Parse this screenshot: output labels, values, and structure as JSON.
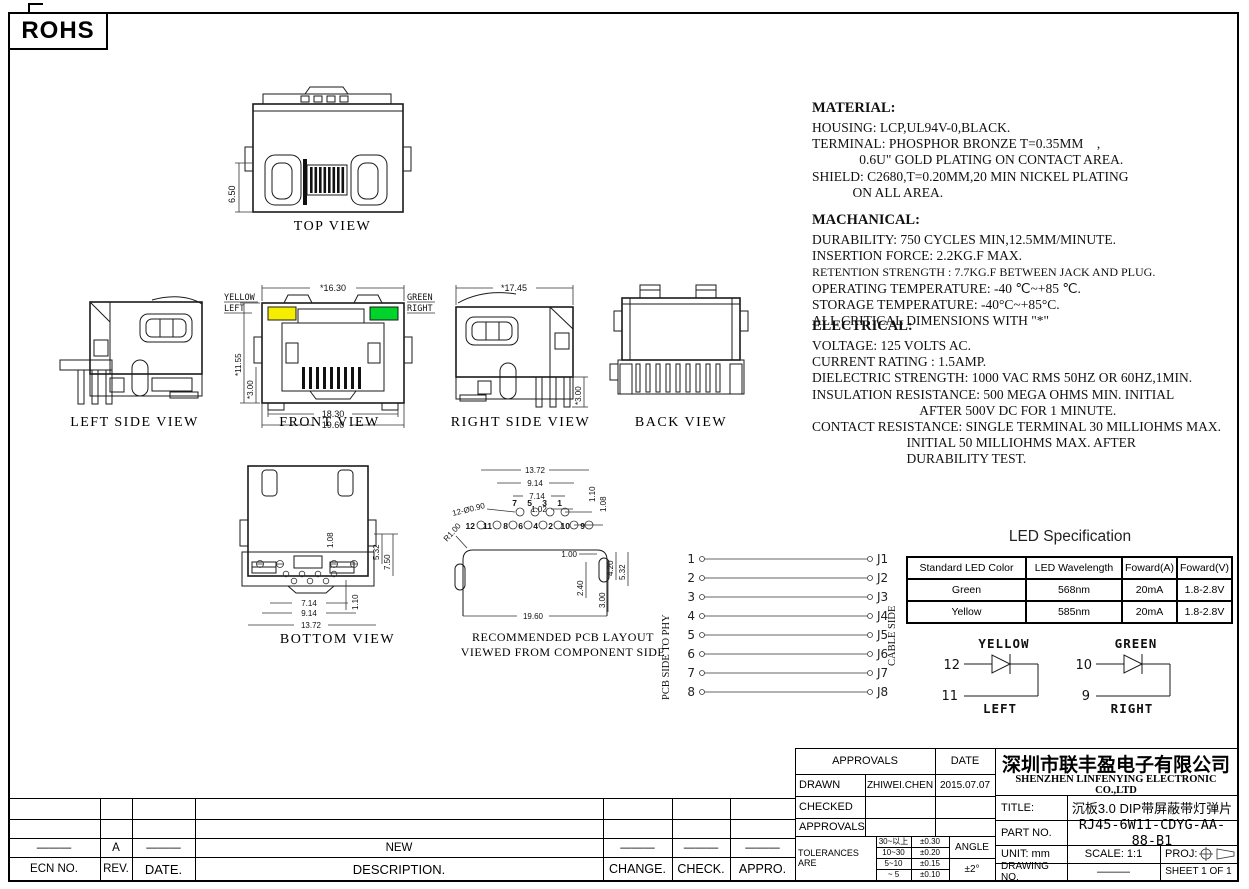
{
  "page": {
    "rohs": "ROHS"
  },
  "views": {
    "top": {
      "label": "TOP VIEW",
      "dim_height": "6.50"
    },
    "left_side": {
      "label": "LEFT SIDE VIEW"
    },
    "front": {
      "label": "FRONT VIEW",
      "dim_width": "*16.30",
      "dim_height": "*11.55",
      "dim_led": "*3.00",
      "dim_inner_width": "18.30",
      "dim_outer_width": "19.60",
      "led_left_color": "YELLOW",
      "led_left_pos": "LEFT",
      "led_right_color": "GREEN",
      "led_right_pos": "RIGHT"
    },
    "right_side": {
      "label": "RIGHT SIDE VIEW",
      "dim_width": "*17.45",
      "dim_pin": "*3.00"
    },
    "back": {
      "label": "BACK VIEW"
    },
    "bottom": {
      "label": "BOTTOM VIEW",
      "dim_1_08": "1.08",
      "dim_5_32": "5.32",
      "dim_7_50": "7.50",
      "dim_1_10": "1.10",
      "dim_7_14": "7.14",
      "dim_9_14": "9.14",
      "dim_13_72": "13.72"
    },
    "pcb": {
      "label_line1": "RECOMMENDED PCB LAYOUT",
      "label_line2": "VIEWED FROM COMPONENT SIDE",
      "dim_13_72": "13.72",
      "dim_9_14": "9.14",
      "dim_7_14": "7.14",
      "dim_1_02": "1.02",
      "dim_1_10": "1.10",
      "dim_1_08": "1.08",
      "hole_note": "12-Ø0.90",
      "radius_note": "R1.00",
      "dim_1_00": "1.00",
      "dim_4_20": "4.20",
      "dim_5_32": "5.32",
      "dim_2_40": "2.40",
      "dim_3_00": "3.00",
      "dim_19_60": "19.60",
      "pins_top": [
        "7",
        "5",
        "3",
        "1"
      ],
      "pins_bottom": [
        "12",
        "11",
        "8",
        "6",
        "4",
        "2",
        "10",
        "9"
      ]
    }
  },
  "wiring": {
    "left_label": "PCB SIDE TO PHY",
    "right_label": "CABLE SIDE",
    "rows": [
      {
        "pin": "1",
        "jack": "J1"
      },
      {
        "pin": "2",
        "jack": "J2"
      },
      {
        "pin": "3",
        "jack": "J3"
      },
      {
        "pin": "4",
        "jack": "J4"
      },
      {
        "pin": "5",
        "jack": "J5"
      },
      {
        "pin": "6",
        "jack": "J6"
      },
      {
        "pin": "7",
        "jack": "J7"
      },
      {
        "pin": "8",
        "jack": "J8"
      }
    ]
  },
  "material": {
    "title": "MATERIAL:",
    "lines": [
      "HOUSING: LCP,UL94V-0,BLACK.",
      "TERMINAL: PHOSPHOR BRONZE T=0.35MM    ,",
      "              0.6U\" GOLD PLATING ON CONTACT AREA.",
      "SHIELD: C2680,T=0.20MM,20 MIN NICKEL PLATING",
      "            ON ALL AREA."
    ]
  },
  "mechanical": {
    "title": "MACHANICAL:",
    "lines": [
      "DURABILITY: 750 CYCLES MIN,12.5MM/MINUTE.",
      "INSERTION FORCE: 2.2KG.F MAX.",
      "RETENTION STRENGTH : 7.7KG.F BETWEEN JACK AND PLUG.",
      "OPERATING TEMPERATURE: -40 ℃~+85 ℃.",
      "STORAGE TEMPERATURE: -40°C~+85°C.",
      "ALL CRITICAL DIMENSIONS WITH \"*\""
    ]
  },
  "electrical": {
    "title": "ELECTRICAL:",
    "lines": [
      "VOLTAGE: 125 VOLTS AC.",
      "CURRENT RATING : 1.5AMP.",
      "DIELECTRIC STRENGTH: 1000 VAC RMS 50HZ OR 60HZ,1MIN.",
      "INSULATION RESISTANCE: 500 MEGA OHMS MIN. INITIAL",
      "                                AFTER 500V DC FOR 1 MINUTE.",
      "CONTACT RESISTANCE: SINGLE TERMINAL 30 MILLIOHMS MAX.",
      "                            INITIAL 50 MILLIOHMS MAX. AFTER",
      "                            DURABILITY TEST."
    ]
  },
  "led_spec": {
    "title": "LED Specification",
    "headers": [
      "Standard LED Color",
      "LED Wavelength",
      "Foward(A)",
      "Foward(V)"
    ],
    "rows": [
      [
        "Green",
        "568nm",
        "20mA",
        "1.8-2.8V"
      ],
      [
        "Yellow",
        "585nm",
        "20mA",
        "1.8-2.8V"
      ]
    ]
  },
  "led_circuits": {
    "left": {
      "color": "YELLOW",
      "pin_anode": "12",
      "pin_cathode": "11",
      "position": "LEFT"
    },
    "right": {
      "color": "GREEN",
      "pin_anode": "10",
      "pin_cathode": "9",
      "position": "RIGHT"
    }
  },
  "colors": {
    "led_yellow": "#F6EE00",
    "led_green": "#00D32A"
  },
  "title_block": {
    "approvals_header": "APPROVALS",
    "date_header": "DATE",
    "drawn_label": "DRAWN",
    "drawn_name": "ZHIWEI.CHEN",
    "drawn_date": "2015.07.07",
    "checked_label": "CHECKED",
    "approvals_label": "APPROVALS",
    "tolerances_label": "TOLERANCES ARE",
    "tolerance_rows": [
      [
        "30~以上",
        "±0.30"
      ],
      [
        "10~30",
        "±0.20"
      ],
      [
        "5~10",
        "±0.15"
      ],
      [
        "~ 5",
        "±0.10"
      ]
    ],
    "angle_label": "ANGLE",
    "angle_value": "±2°",
    "company_cn": "深圳市联丰盈电子有限公司",
    "company_en": "SHENZHEN LINFENYING ELECTRONIC CO.,LTD",
    "title_label": "TITLE:",
    "title_value": "沉板3.0 DIP带屏蔽带灯弹片",
    "part_label": "PART NO.",
    "part_value": "RJ45-6W11-CDYG-AA-88-B1",
    "unit_label": "UNIT: mm",
    "scale_label": "SCALE: 1:1",
    "proj_label": "PROJ:",
    "drawing_label": "DRAWING NO.",
    "drawing_value": "———",
    "sheet_label": "SHEET 1 OF 1"
  },
  "revision_table": {
    "headers": {
      "ecn": "ECN NO.",
      "rev": "REV.",
      "date": "DATE.",
      "description": "DESCRIPTION.",
      "change": "CHANGE.",
      "check": "CHECK.",
      "appro": "APPRO."
    },
    "row": {
      "ecn": "———",
      "rev": "A",
      "date": "———",
      "description": "NEW",
      "change": "———",
      "check": "———",
      "appro": "———"
    }
  }
}
